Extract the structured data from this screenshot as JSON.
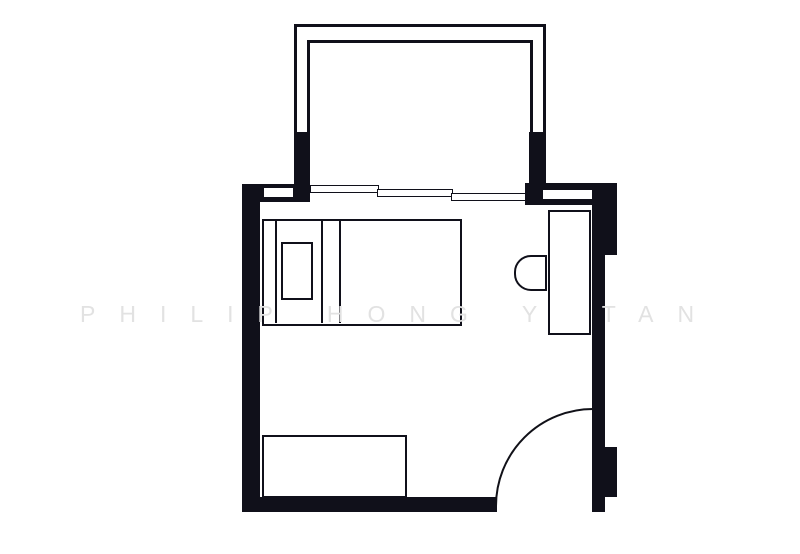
{
  "watermark": {
    "text": "PHILIP HONG YUTAN"
  },
  "colors": {
    "ink": "#10101a",
    "paper": "#ffffff",
    "wm": "#e2e2e2"
  },
  "plan": {
    "type": "bedroom-floor-plan",
    "elements": [
      "balcony",
      "sliding-window",
      "wall-opening-left",
      "wall-opening-right",
      "bed",
      "headboard",
      "pillow",
      "blanket-folds",
      "desk",
      "chair",
      "dresser",
      "door-swing",
      "walls"
    ]
  }
}
